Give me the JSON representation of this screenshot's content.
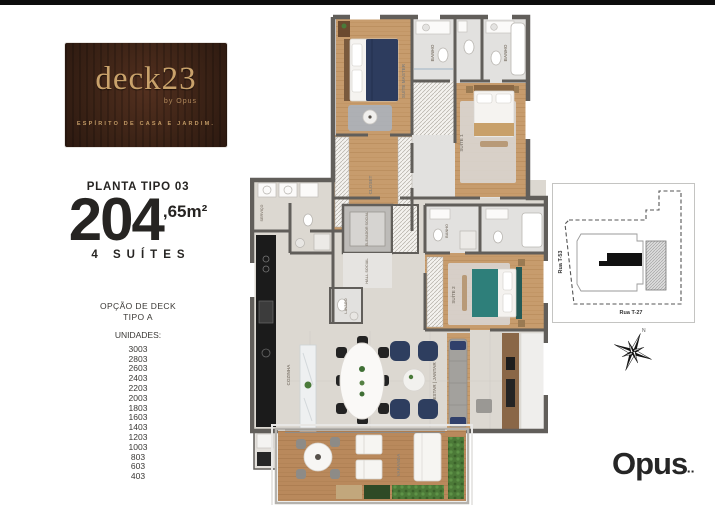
{
  "brand": {
    "logo_title": "deck23",
    "logo_by": "by Opus",
    "logo_tagline": "ESPÍRITO DE CASA E JARDIM.",
    "logo_bg": "#3c2316",
    "logo_gold": "#c9a26b"
  },
  "plan_info": {
    "label": "PLANTA TIPO 03",
    "area_main": "204",
    "area_suffix": ",65m²",
    "suites": "4 SUÍTES",
    "deck_option_line1": "OPÇÃO DE DECK",
    "deck_option_line2": "TIPO A",
    "units_label": "UNIDADES:",
    "units": [
      "3003",
      "2803",
      "2603",
      "2403",
      "2203",
      "2003",
      "1803",
      "1603",
      "1403",
      "1203",
      "1003",
      "803",
      "603",
      "403"
    ]
  },
  "floorplan": {
    "wall_color": "#615e5a",
    "wood_color": "#c79c6d",
    "deck_color": "#b9895c",
    "accent_navy": "#2e3e5f",
    "accent_teal": "#2e7f7a",
    "rooms": [
      {
        "name": "SUÍTE MASTER"
      },
      {
        "name": "BANHO"
      },
      {
        "name": "BANHO"
      },
      {
        "name": "SUÍTE 1"
      },
      {
        "name": "CLOSET"
      },
      {
        "name": "ELEVADOR SOCIAL"
      },
      {
        "name": "HALL SOCIAL"
      },
      {
        "name": "LAVABO"
      },
      {
        "name": "BANHO"
      },
      {
        "name": "SUÍTE 2"
      },
      {
        "name": "COZINHA"
      },
      {
        "name": "ESTAR | JANTAR"
      },
      {
        "name": "VARANDA"
      },
      {
        "name": "SERVIÇO"
      }
    ]
  },
  "site_map": {
    "street_left": "Rua T-53",
    "street_bottom": "Rua T-27"
  },
  "compass": {
    "north_label": "N"
  },
  "footer": {
    "logo": "Opus",
    "mark": "▪▪"
  }
}
